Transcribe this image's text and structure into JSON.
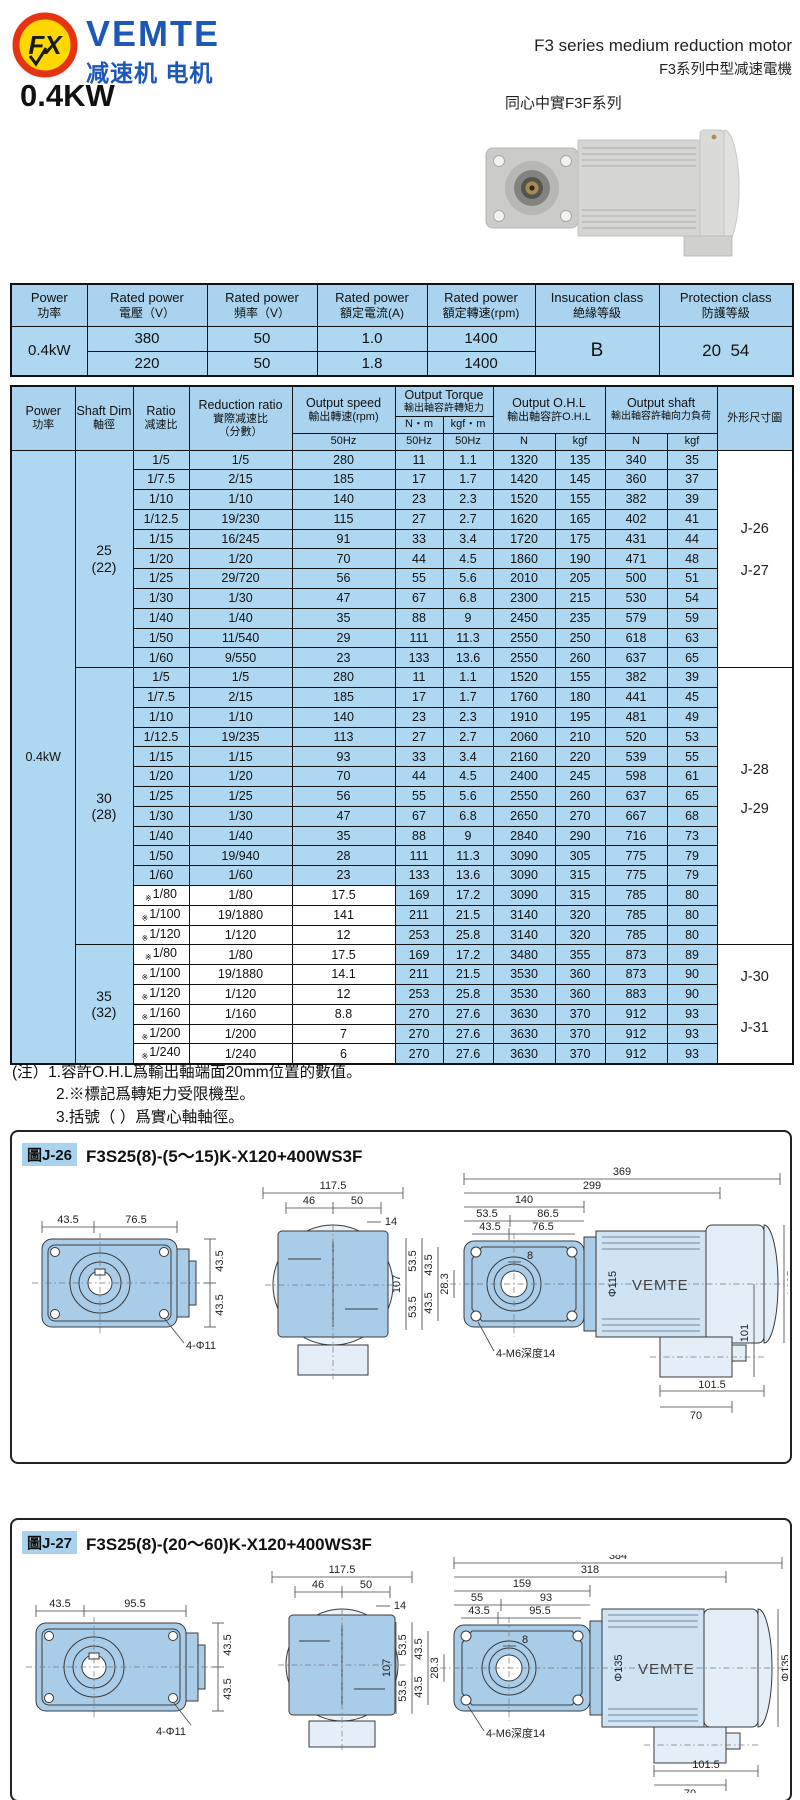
{
  "colors": {
    "table_blue": "#aed8f2",
    "header_blue": "#a9d3ee",
    "brand_blue": "#1d57b8",
    "logo_red": "#e63312",
    "logo_yellow": "#ffd800",
    "drawing_blue": "#a9cce8",
    "border": "#111111"
  },
  "header": {
    "logo_mark": "FX",
    "brand": "VEMTE",
    "brand_sub": "减速机 电机",
    "title_en": "F3 series medium reduction motor",
    "title_zh": "F3系列中型减速電機",
    "series": "同心中實F3F系列",
    "power_heading": "0.4KW"
  },
  "power_table": {
    "columns": [
      {
        "en": "Power",
        "zh": "功率"
      },
      {
        "en": "Rated power",
        "zh": "電壓（V）"
      },
      {
        "en": "Rated power",
        "zh": "頻率（V）"
      },
      {
        "en": "Rated power",
        "zh": "額定電流(A)"
      },
      {
        "en": "Rated power",
        "zh": "額定轉速(rpm)"
      },
      {
        "en": "Insucation class",
        "zh": "絶緣等級"
      },
      {
        "en": "Protection class",
        "zh": "防護等級"
      }
    ],
    "power": "0.4kW",
    "rows": [
      [
        "380",
        "50",
        "1.0",
        "1400"
      ],
      [
        "220",
        "50",
        "1.8",
        "1400"
      ]
    ],
    "insulation": "B",
    "protection": "20  54"
  },
  "spec_table": {
    "headers": {
      "power_en": "Power",
      "power_zh": "功率",
      "shaft_en": "Shaft Dim",
      "shaft_zh": "軸徑",
      "ratio_en": "Ratio",
      "ratio_zh": "减速比",
      "reduction_en": "Reduction ratio",
      "reduction_zh1": "實際减速比",
      "reduction_zh2": "（分數）",
      "speed_en": "Output speed",
      "speed_zh": "輸出轉速(rpm)",
      "torque_en": "Output Torque",
      "torque_zh": "輸出軸容許轉矩力",
      "nm": "N・m",
      "kgfm": "kgf・m",
      "ohl_en": "Output O.H.L",
      "ohl_zh": "輸出軸容許O.H.L",
      "shaft_out_en": "Output shaft",
      "shaft_out_zh": "輸出軸容許軸向力負荷",
      "hz": "50Hz",
      "n": "N",
      "kgf": "kgf",
      "figure": "外形尺寸圖"
    },
    "power": "0.4kW",
    "star_mark": "※",
    "sections": [
      {
        "shaft": "25",
        "paren": "(22)",
        "figs": [
          {
            "label": "J-26",
            "at": 4.2
          },
          {
            "label": "J-27",
            "at": 6.4
          }
        ],
        "rows": [
          [
            "1/5",
            "1/5",
            "280",
            "11",
            "1.1",
            "1320",
            "135",
            "340",
            "35",
            false
          ],
          [
            "1/7.5",
            "2/15",
            "185",
            "17",
            "1.7",
            "1420",
            "145",
            "360",
            "37",
            false
          ],
          [
            "1/10",
            "1/10",
            "140",
            "23",
            "2.3",
            "1520",
            "155",
            "382",
            "39",
            false
          ],
          [
            "1/12.5",
            "19/230",
            "115",
            "27",
            "2.7",
            "1620",
            "165",
            "402",
            "41",
            false
          ],
          [
            "1/15",
            "16/245",
            "91",
            "33",
            "3.4",
            "1720",
            "175",
            "431",
            "44",
            false
          ],
          [
            "1/20",
            "1/20",
            "70",
            "44",
            "4.5",
            "1860",
            "190",
            "471",
            "48",
            false
          ],
          [
            "1/25",
            "29/720",
            "56",
            "55",
            "5.6",
            "2010",
            "205",
            "500",
            "51",
            false
          ],
          [
            "1/30",
            "1/30",
            "47",
            "67",
            "6.8",
            "2300",
            "215",
            "530",
            "54",
            false
          ],
          [
            "1/40",
            "1/40",
            "35",
            "88",
            "9",
            "2450",
            "235",
            "579",
            "59",
            false
          ],
          [
            "1/50",
            "11/540",
            "29",
            "111",
            "11.3",
            "2550",
            "250",
            "618",
            "63",
            false
          ],
          [
            "1/60",
            "9/550",
            "23",
            "133",
            "13.6",
            "2550",
            "260",
            "637",
            "65",
            false
          ]
        ]
      },
      {
        "shaft": "30",
        "paren": "(28)",
        "figs": [
          {
            "label": "J-28",
            "at": 5.4
          },
          {
            "label": "J-29",
            "at": 7.5
          }
        ],
        "rows": [
          [
            "1/5",
            "1/5",
            "280",
            "11",
            "1.1",
            "1520",
            "155",
            "382",
            "39",
            false
          ],
          [
            "1/7.5",
            "2/15",
            "185",
            "17",
            "1.7",
            "1760",
            "180",
            "441",
            "45",
            false
          ],
          [
            "1/10",
            "1/10",
            "140",
            "23",
            "2.3",
            "1910",
            "195",
            "481",
            "49",
            false
          ],
          [
            "1/12.5",
            "19/235",
            "113",
            "27",
            "2.7",
            "2060",
            "210",
            "520",
            "53",
            false
          ],
          [
            "1/15",
            "1/15",
            "93",
            "33",
            "3.4",
            "2160",
            "220",
            "539",
            "55",
            false
          ],
          [
            "1/20",
            "1/20",
            "70",
            "44",
            "4.5",
            "2400",
            "245",
            "598",
            "61",
            false
          ],
          [
            "1/25",
            "1/25",
            "56",
            "55",
            "5.6",
            "2550",
            "260",
            "637",
            "65",
            false
          ],
          [
            "1/30",
            "1/30",
            "47",
            "67",
            "6.8",
            "2650",
            "270",
            "667",
            "68",
            false
          ],
          [
            "1/40",
            "1/40",
            "35",
            "88",
            "9",
            "2840",
            "290",
            "716",
            "73",
            false
          ],
          [
            "1/50",
            "19/940",
            "28",
            "111",
            "11.3",
            "3090",
            "305",
            "775",
            "79",
            false
          ],
          [
            "1/60",
            "1/60",
            "23",
            "133",
            "13.6",
            "3090",
            "315",
            "775",
            "79",
            false
          ],
          [
            "1/80",
            "1/80",
            "17.5",
            "169",
            "17.2",
            "3090",
            "315",
            "785",
            "80",
            true
          ],
          [
            "1/100",
            "19/1880",
            "141",
            "211",
            "21.5",
            "3140",
            "320",
            "785",
            "80",
            true
          ],
          [
            "1/120",
            "1/120",
            "12",
            "253",
            "25.8",
            "3140",
            "320",
            "785",
            "80",
            true
          ]
        ]
      },
      {
        "shaft": "35",
        "paren": "(32)",
        "figs": [
          {
            "label": "J-30",
            "at": 1.7
          },
          {
            "label": "J-31",
            "at": 4.4
          }
        ],
        "rows": [
          [
            "1/80",
            "1/80",
            "17.5",
            "169",
            "17.2",
            "3480",
            "355",
            "873",
            "89",
            true
          ],
          [
            "1/100",
            "19/1880",
            "14.1",
            "211",
            "21.5",
            "3530",
            "360",
            "873",
            "90",
            true
          ],
          [
            "1/120",
            "1/120",
            "12",
            "253",
            "25.8",
            "3530",
            "360",
            "883",
            "90",
            true
          ],
          [
            "1/160",
            "1/160",
            "8.8",
            "270",
            "27.6",
            "3630",
            "370",
            "912",
            "93",
            true
          ],
          [
            "1/200",
            "1/200",
            "7",
            "270",
            "27.6",
            "3630",
            "370",
            "912",
            "93",
            true
          ],
          [
            "1/240",
            "1/240",
            "6",
            "270",
            "27.6",
            "3630",
            "370",
            "912",
            "93",
            true
          ]
        ]
      }
    ]
  },
  "notes": {
    "prefix": "(注）",
    "items": [
      "1.容許O.H.L爲輸出軸端面20mm位置的數值。",
      "2.※標記爲轉矩力受限機型。",
      "3.括號（ ）爲實心軸軸徑。"
    ]
  },
  "diagrams": [
    {
      "tag": "圖J-26",
      "model": "F3S25(8)-(5～15)K-X120+400WS3F",
      "lv": {
        "a": "43.5",
        "b": "76.5",
        "r1": "43.5",
        "r2": "43.5",
        "holes": "4-Φ11"
      },
      "mv": {
        "w": "117.5",
        "w1": "46",
        "w2": "50",
        "off": "14"
      },
      "rv": {
        "total": "369",
        "body": "299",
        "gear": "140",
        "a": "53.5",
        "b": "86.5",
        "c": "43.5",
        "d": "76.5",
        "shaft": "8",
        "vt": "107",
        "v1": "53.5",
        "v2": "53.5",
        "v3": "43.5",
        "v4": "43.5",
        "v5": "28.3",
        "dia1": "Φ115",
        "dia2": "Φ135",
        "brand": "VEMTE",
        "h": "101",
        "tap": "4-M6深度14",
        "b1": "101.5",
        "b2": "70"
      }
    },
    {
      "tag": "圖J-27",
      "model": "F3S25(8)-(20～60)K-X120+400WS3F",
      "lv": {
        "a": "43.5",
        "b": "95.5",
        "r1": "43.5",
        "r2": "43.5",
        "holes": "4-Φ11"
      },
      "mv": {
        "w": "117.5",
        "w1": "46",
        "w2": "50",
        "off": "14"
      },
      "rv": {
        "total": "384",
        "body": "318",
        "gear": "159",
        "a": "55",
        "b": "93",
        "c": "43.5",
        "d": "95.5",
        "shaft": "8",
        "vt": "107",
        "v1": "53.5",
        "v2": "53.5",
        "v3": "43.5",
        "v4": "43.5",
        "v5": "28.3",
        "dia1": "Φ135",
        "dia2": "Φ135",
        "brand": "VEMTE",
        "tap": "4-M6深度14",
        "b1": "101.5",
        "b2": "70"
      }
    }
  ]
}
